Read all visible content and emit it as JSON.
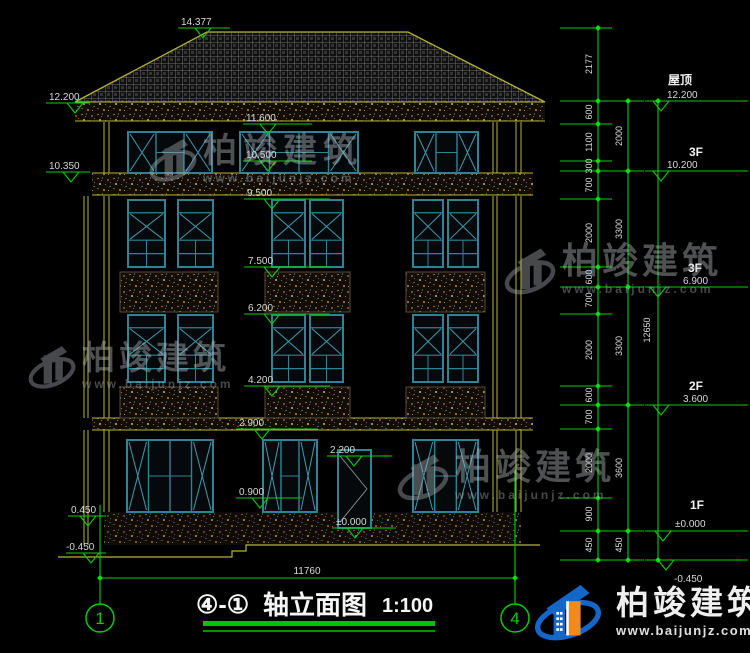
{
  "title": {
    "prefix": "④-①",
    "name": "轴立面图",
    "scale": "1:100"
  },
  "axis": {
    "left": "1",
    "right": "4"
  },
  "dims": {
    "bottom": "11760",
    "overall": "12650"
  },
  "markers": {
    "center": [
      "14.377",
      "11.600",
      "10.500",
      "9.500",
      "7.500",
      "6.200",
      "4.200",
      "2.900",
      "2.200",
      "0.900",
      "±0.000"
    ],
    "left": [
      "12.200",
      "10.350",
      "0.450",
      "-0.450"
    ]
  },
  "floors": [
    {
      "label": "屋顶",
      "value": "12.200"
    },
    {
      "label": "3F",
      "value": "10.200"
    },
    {
      "label": "3F",
      "value": "6.900"
    },
    {
      "label": "2F",
      "value": "3.600"
    },
    {
      "label": "1F",
      "value": "±0.000"
    },
    {
      "label": "",
      "value": "-0.450"
    }
  ],
  "chains": {
    "c1": [
      "2177",
      "600",
      "1100",
      "300",
      "700",
      "2000",
      "600",
      "700",
      "2000",
      "600",
      "700",
      "2000",
      "900",
      "450"
    ],
    "c2": [
      "2000",
      "3300",
      "3300",
      "3600",
      "450"
    ]
  },
  "watermark": {
    "name": "柏竣建筑",
    "url": "www.baijunjz.com"
  },
  "brand": {
    "name": "柏竣建筑",
    "url": "www.baijunjz.com"
  }
}
